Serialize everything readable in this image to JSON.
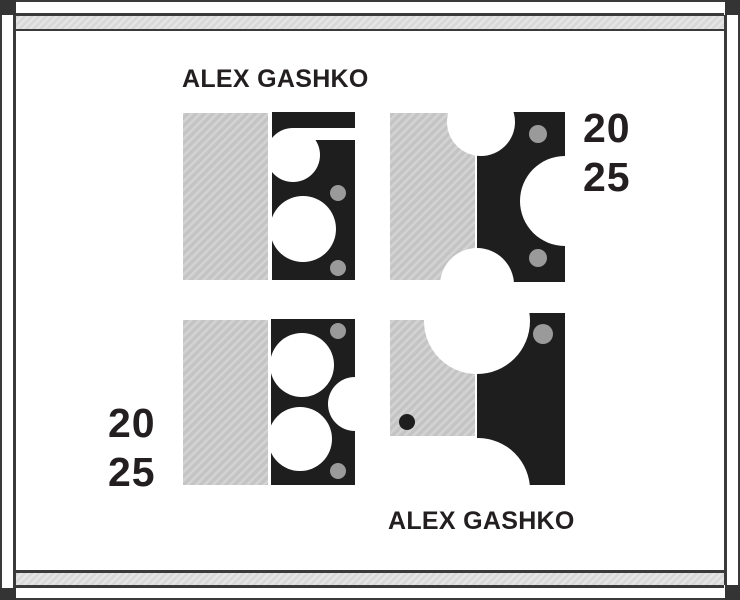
{
  "poster": {
    "artist_top": "ALEX GASHKO",
    "artist_bottom": "ALEX GASHKO",
    "year_top_right": {
      "line1": "20",
      "line2": "25"
    },
    "year_bottom_left": {
      "line1": "20",
      "line2": "25"
    }
  },
  "colors": {
    "background": "#ffffff",
    "plate_black": "#1e1e1e",
    "hatch_gray_base": "#c4c4c4",
    "hatch_gray_line": "#d3d3d3",
    "rivet_dot_gray": "#9a9a9a",
    "frame_dark": "#3a3a3a",
    "frame_band_gray": "#d9d9d9",
    "text": "#231f20"
  },
  "figures": [
    {
      "id": "figure-top-left",
      "description": "hatched gray block beside black plate with keyhole slot and large circle cutout, two gray rivet dots"
    },
    {
      "id": "figure-top-right",
      "description": "hatched gray block and black plate with semicircular notches top, bottom and right, two gray rivet dots"
    },
    {
      "id": "figure-bottom-left",
      "description": "hatched gray block beside black plate with two large circle cutouts and right edge notch, two gray rivet dots"
    },
    {
      "id": "figure-bottom-right",
      "description": "hatched gray block with black dot beside black plate scooped top-left and bottom-left, one gray rivet dot"
    }
  ]
}
